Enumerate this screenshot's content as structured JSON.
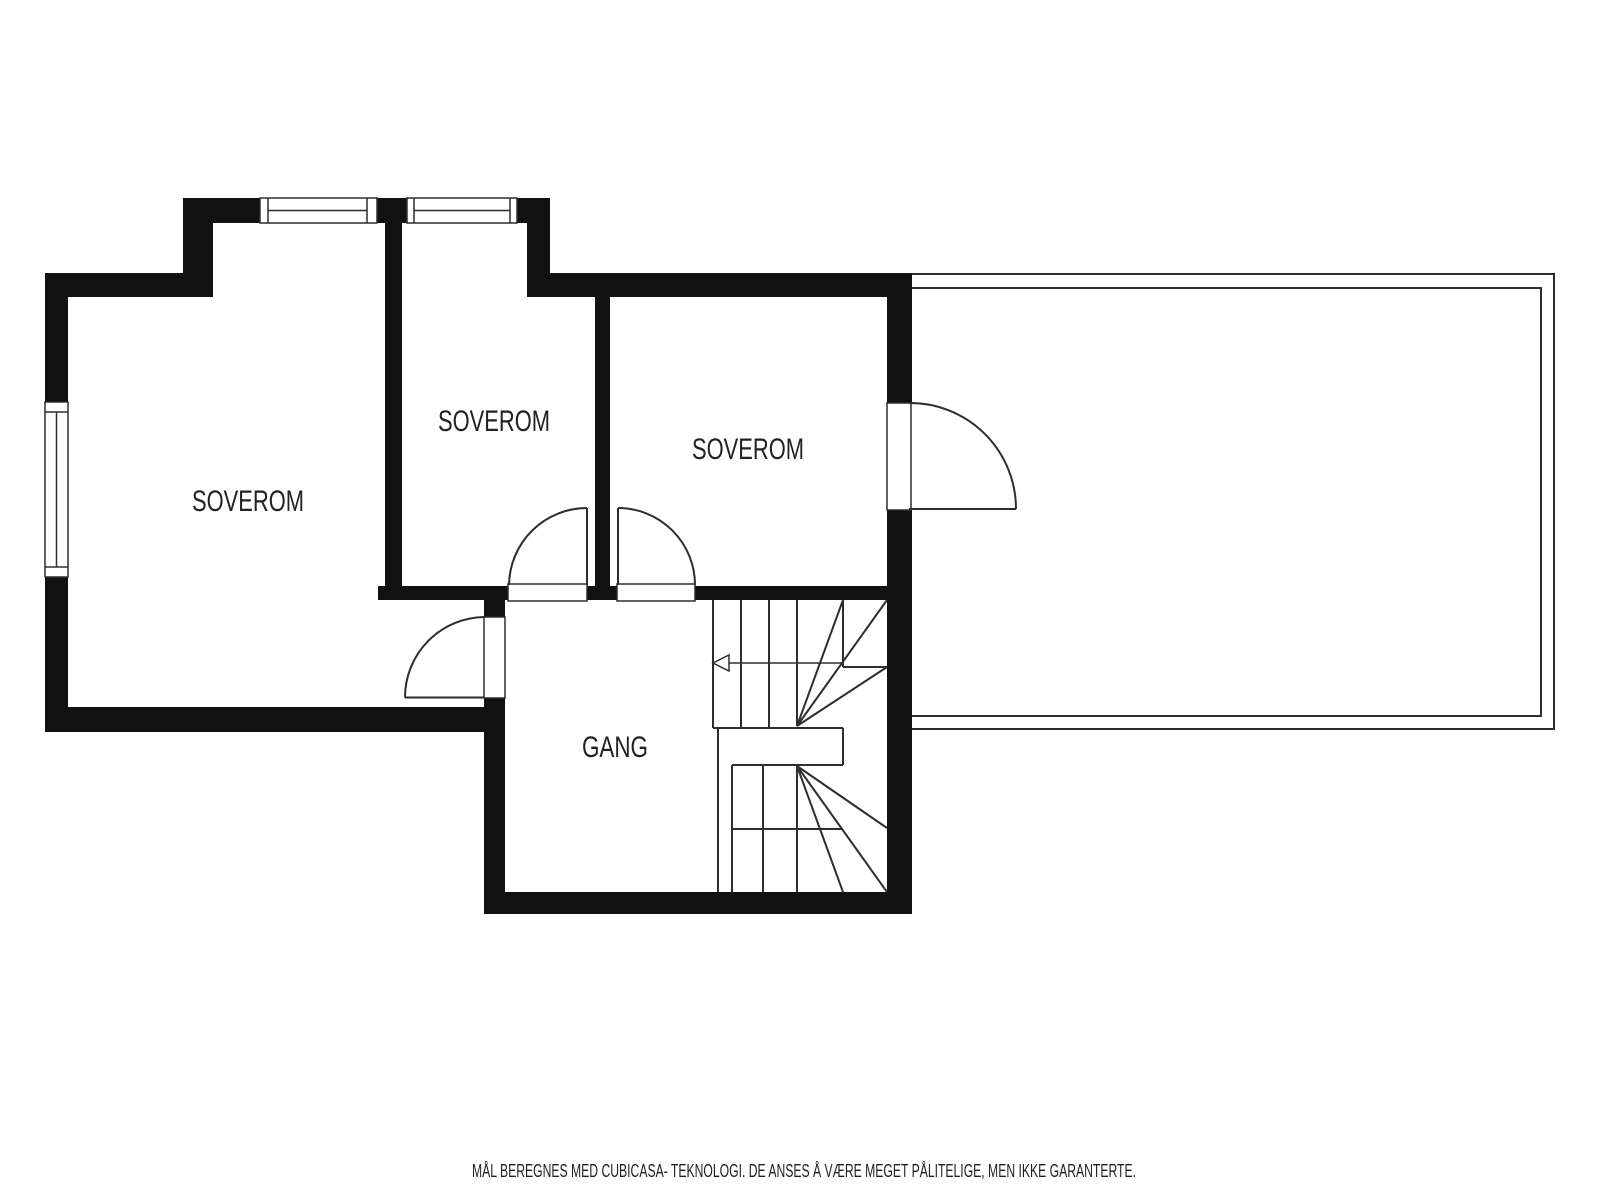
{
  "plan": {
    "type": "floor-plan",
    "rooms": [
      {
        "id": "soverom-left",
        "label": "SOVEROM"
      },
      {
        "id": "soverom-middle",
        "label": "SOVEROM"
      },
      {
        "id": "soverom-right",
        "label": "SOVEROM"
      },
      {
        "id": "gang",
        "label": "GANG"
      }
    ]
  },
  "footer": {
    "disclaimer": "MÅL BEREGNES MED CUBICASA- TEKNOLOGI. DE ANSES Å VÆRE MEGET PÅLITELIGE, MEN IKKE GARANTERTE."
  },
  "colors": {
    "walls": "#111111",
    "lines": "#2e2e2e",
    "text": "#222222",
    "background": "#ffffff"
  }
}
